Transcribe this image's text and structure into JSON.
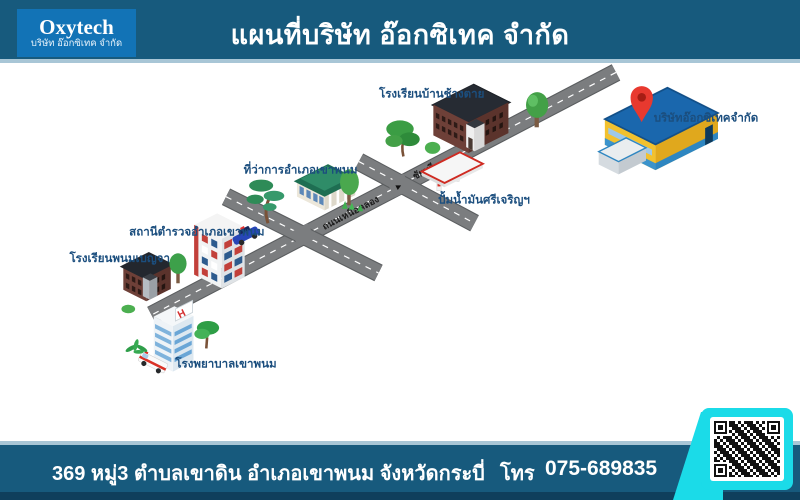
{
  "header": {
    "logo": {
      "brand": "Oxytech",
      "subtitle": "บริษัท อ๊อกซิเทค จำกัด"
    },
    "title": "แผนที่บริษัท อ๊อกซิเทค จำกัด"
  },
  "map": {
    "locations": {
      "school_chang_tai": "โรงเรียนบ้านช้างตาย",
      "company": "บริษัทอ๊อกซิเทคจำกัด",
      "district_office": "ที่ว่าการอำเภอเขาพนม",
      "police_station": "สถานีตำรวจอำเภอเขาพนม",
      "school_phanom_bencha": "โรงเรียนพนมเบญจา",
      "hospital": "โรงพยาบาลเขาพนม",
      "hospital_sign": "H",
      "gas_station": "ปั้มน้ำมันศรีเจริญฯ"
    },
    "roads": {
      "road_name": "ถนนเหนือคลอง",
      "direction": "ชัยบุรี"
    }
  },
  "footer": {
    "address": "369 หมู่3 ตำบลเขาดิน อำเภอเขาพนม จังหวัดกระบี่",
    "phone_label": "โทร",
    "phone": "075-689835"
  },
  "colors": {
    "header_bg": "#175a7d",
    "footer_dark_strip": "#0f3f5c",
    "separator_line": "#a8c6d6",
    "logo_bg": "#1273b6",
    "label_navy": "#1b4e7e",
    "road_gray": "#7b7d7f",
    "pin_red": "#e8392f",
    "qr_cyan": "#1bdbe8",
    "company_yellow": "#f2c12e",
    "company_roof_blue": "#1a67ad"
  }
}
